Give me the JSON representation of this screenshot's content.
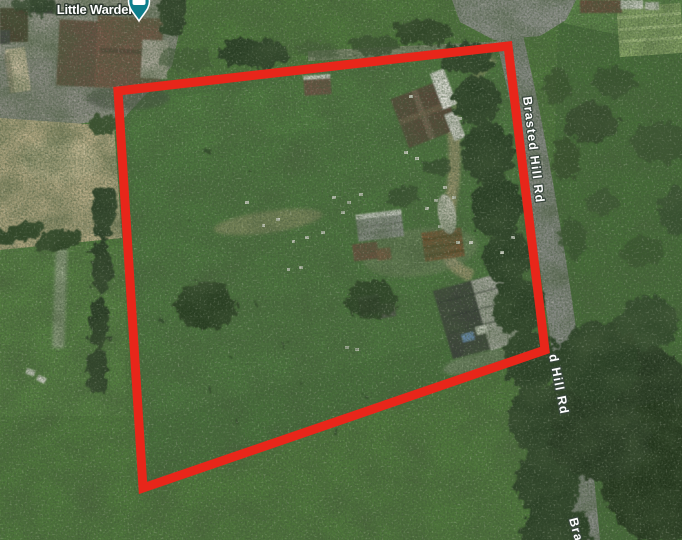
{
  "map": {
    "view_type": "satellite",
    "place_label": {
      "text": "Little Warden"
    },
    "marker": {
      "type": "lodging",
      "icon": "bed-icon",
      "color": "#0d7e8c"
    },
    "road_labels": [
      {
        "text": "Brasted Hill Rd"
      },
      {
        "text": "d Hill Rd"
      },
      {
        "text": "Bra"
      }
    ],
    "boundary": {
      "shape": "quadrilateral",
      "points": "118,91 508,46 545,350 143,488",
      "color": "#e8261a",
      "stroke_width": "9"
    },
    "palette": {
      "grass_green": "#517c3e",
      "tree_green": "#2c3f26",
      "road_gray": "#8b8e8a",
      "dirt_tan": "#beb18b",
      "label_white": "#ffffff"
    }
  }
}
